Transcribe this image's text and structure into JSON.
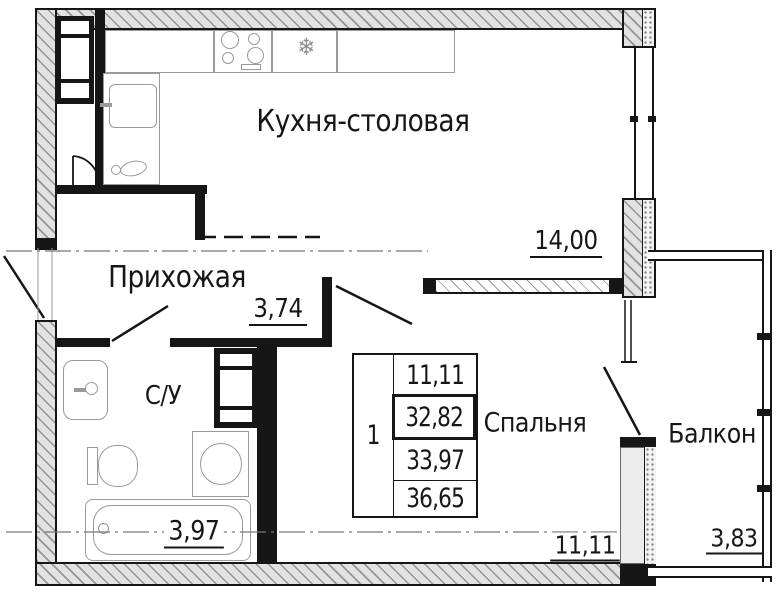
{
  "rooms": {
    "kitchen": {
      "label": "Кухня-столовая",
      "area": "14,00"
    },
    "hallway": {
      "label": "Прихожая",
      "area": "3,74"
    },
    "bathroom": {
      "label": "С/У",
      "area": "3,97"
    },
    "bedroom": {
      "label": "Спальня",
      "area": "11,11"
    },
    "balcony": {
      "label": "Балкон",
      "area": "3,83"
    }
  },
  "stamp": {
    "rooms_count": "1",
    "values": [
      "11,11",
      "32,82",
      "33,97",
      "36,65"
    ]
  },
  "icons": {
    "freezer": "❄"
  },
  "colors": {
    "line": "#161616",
    "thin_line": "#9a9a9a",
    "wall_fill": "#e2e2e2"
  }
}
